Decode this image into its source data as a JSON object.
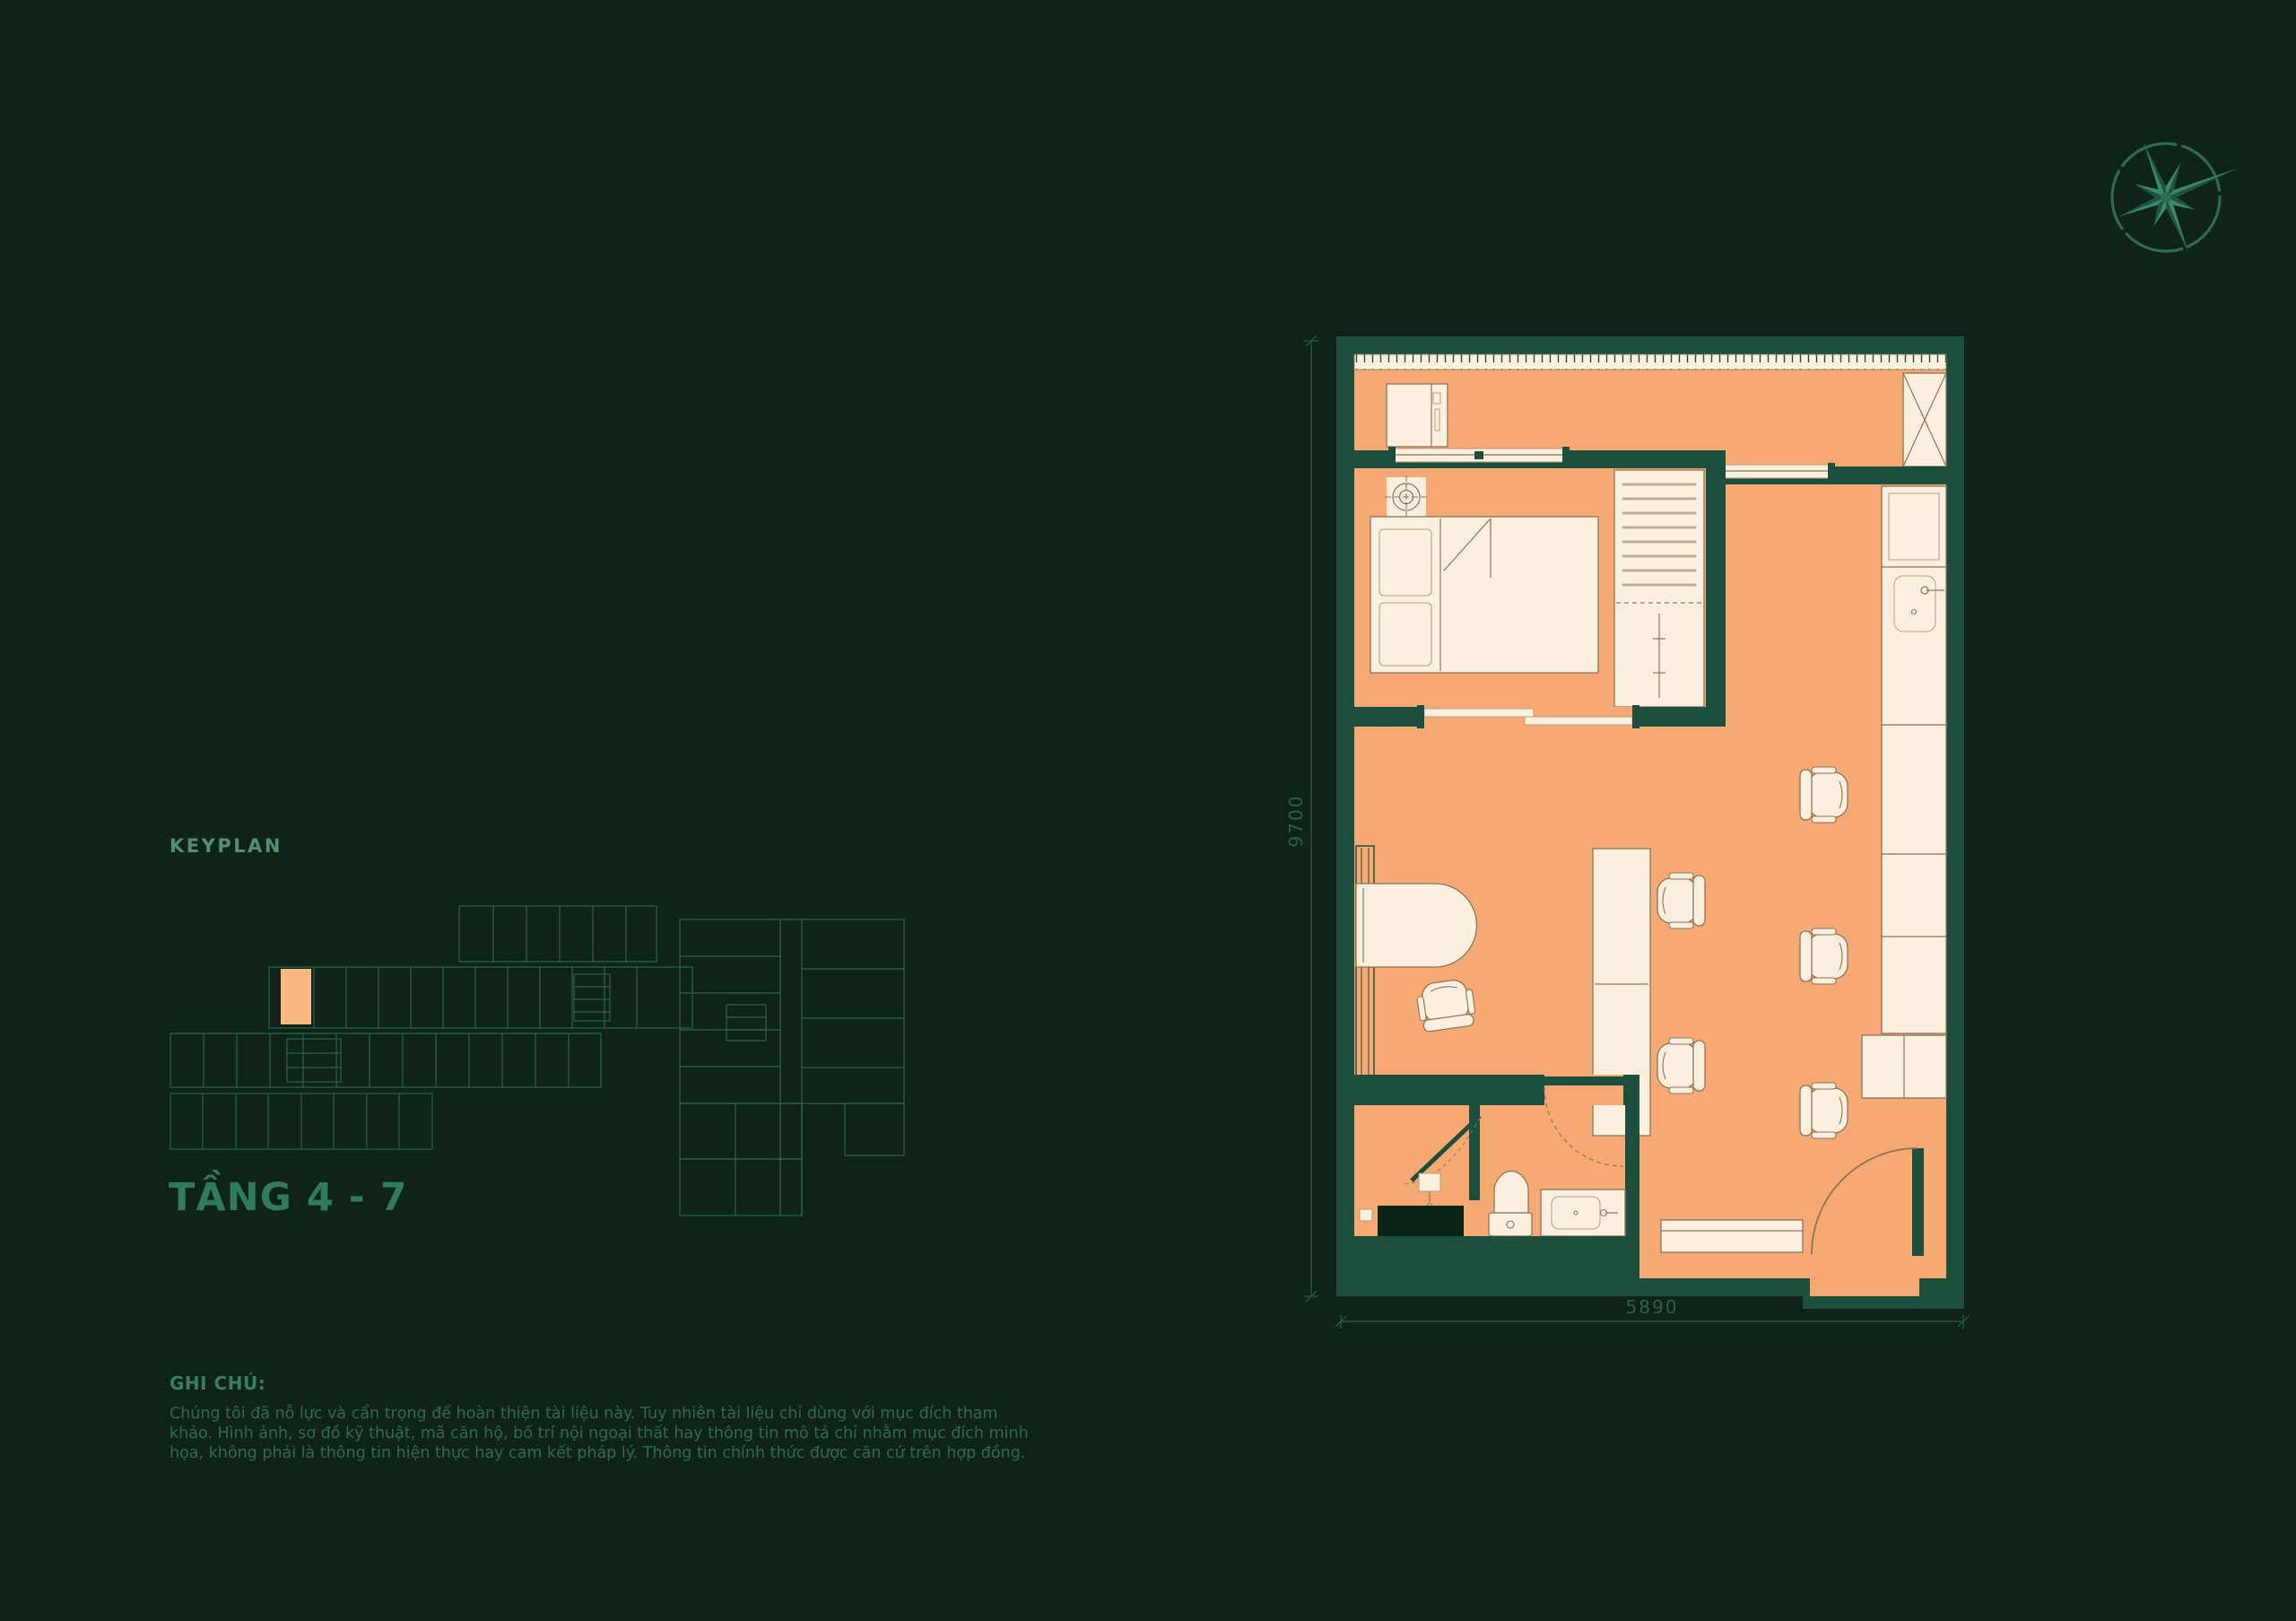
{
  "colors": {
    "background": "#10231b",
    "wall": "#1d4f3e",
    "floor": "#f6a972",
    "furniture": "#fbefdf",
    "furniture_stroke": "#8d7556",
    "line_green": "#2e6b51",
    "text_green": "#2d6b50",
    "highlight_unit": "#f8b87e"
  },
  "icons": {
    "compass": "compass-rose-icon"
  },
  "keyplan": {
    "label": "KEYPLAN",
    "floor_label": "TẦNG 4 - 7"
  },
  "notes": {
    "label": "GHI CHÚ:",
    "body": "Chúng tôi đã nỗ lực và cẩn trọng để hoàn thiện tài liệu này. Tuy nhiên tài liệu chỉ dùng với mục đích tham khảo. Hình ảnh, sơ đồ kỹ thuật, mã căn hộ, bố trí nội ngoại thất hay thông tin mô tả chỉ nhằm mục đích minh họa, không phải là thông tin hiện thực hay cam kết pháp lý. Thông tin chính thức được căn cứ trên hợp đồng."
  },
  "floorplan": {
    "dim_height": "9700",
    "dim_width": "5890"
  }
}
